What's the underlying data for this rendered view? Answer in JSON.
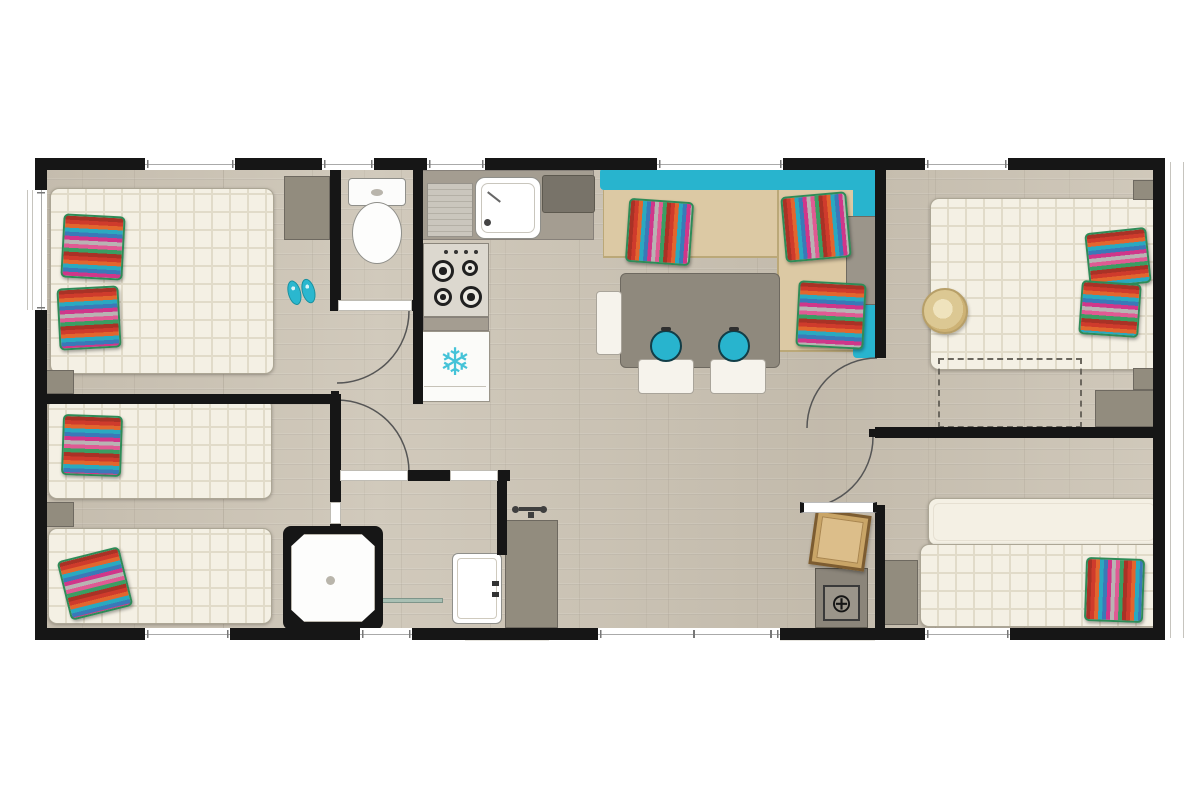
{
  "title": "Mobile home floor plan — top-down view",
  "colors": {
    "wall": "#161616",
    "floor": "#cdc5b6",
    "mattress": "#f4f0e4",
    "quilt": "#e1dbc9",
    "teal": "#28b4ce",
    "seat": "#dcc9a4",
    "furn-gray": "#928c7e",
    "counter": "#a49d91",
    "appliance-dark": "#787369",
    "white-goods": "#fbfbf9",
    "wood-box": "#c9a567",
    "hat": "#d8c38c",
    "glass": "#a9c0b4",
    "door-arc": "#555555",
    "snowflake": "#45c3d8",
    "pillow-edge": "#2e8b57",
    "pillow_stripes": [
      "#a93226",
      "#cf3b2c",
      "#e2662e",
      "#2aa9c0",
      "#3a79b8",
      "#d0368a",
      "#b9b3b3",
      "#e05a93",
      "#3a9e63"
    ]
  },
  "glyphs": {
    "snowflake": "❄",
    "technical_unit": "⊕"
  },
  "rooms": [
    {
      "id": "bedroom-left-master",
      "name": "Bedroom — double bed",
      "furniture": [
        "double-bed",
        "striped-pillow",
        "striped-pillow",
        "wardrobe",
        "bedside-table",
        "flip-flops"
      ]
    },
    {
      "id": "bedroom-left-twin",
      "name": "Bedroom — twin beds",
      "furniture": [
        "single-bed",
        "single-bed",
        "striped-pillow",
        "striped-pillow",
        "bedside-table"
      ]
    },
    {
      "id": "wc",
      "name": "WC",
      "furniture": [
        "toilet"
      ]
    },
    {
      "id": "kitchen",
      "name": "Kitchen",
      "furniture": [
        "worktop",
        "drainboard",
        "sink",
        "cooktop-4-burners",
        "fridge-freezer"
      ]
    },
    {
      "id": "living-dining",
      "name": "Living / dining",
      "furniture": [
        "corner-sofa",
        "striped-pillow",
        "striped-pillow",
        "striped-pillow",
        "sofa-side-table",
        "dining-table",
        "stool",
        "stool",
        "chair",
        "chair",
        "bench"
      ]
    },
    {
      "id": "bathroom",
      "name": "Shower room",
      "furniture": [
        "shower",
        "glass-door",
        "washbasin",
        "vanity-unit",
        "mixer-tap"
      ]
    },
    {
      "id": "bedroom-right-master",
      "name": "Bedroom — double bed",
      "furniture": [
        "double-bed",
        "striped-pillow",
        "striped-pillow",
        "sun-hat",
        "bedside-table",
        "bedside-table",
        "dresser",
        "optional-extension-outline"
      ]
    },
    {
      "id": "bedroom-right-twin",
      "name": "Bedroom — twin beds",
      "furniture": [
        "single-bed",
        "single-bed",
        "striped-pillow",
        "cabinet",
        "storage-box",
        "technical-unit"
      ]
    }
  ],
  "labels": {
    "plan": "Mobile home floor plan — top-down view",
    "master_bed_left": "double bed",
    "master_bed_right": "double bed",
    "toilet": "toilet",
    "fridge": "fridge-freezer",
    "cooktop": "4-burner cooktop",
    "sink": "kitchen sink",
    "sofa": "corner sofa",
    "dining_table": "dining table",
    "shower": "shower cubicle",
    "washbasin": "washbasin"
  },
  "openings": {
    "windows_top": 5,
    "windows_bottom": 4,
    "windows_left": 1,
    "interior_doors": 4
  }
}
